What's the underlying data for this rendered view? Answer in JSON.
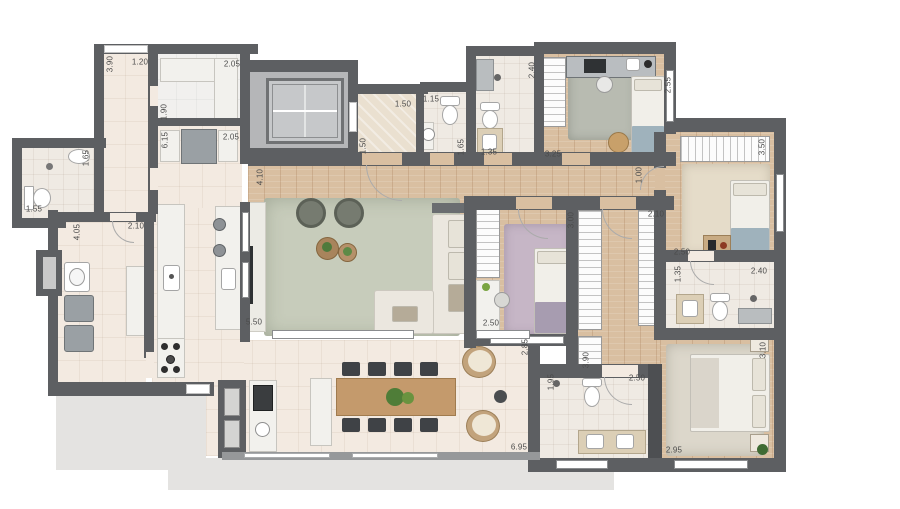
{
  "plan": {
    "type": "apartment-floor-plan-top-view",
    "unit_hint": "meters",
    "colors": {
      "wall": "#5d5f62",
      "wood_floor": "#d9bfa1",
      "tile_floor": "#f3eae1",
      "common_area_floor": "#b5b6b8",
      "living_rug": "#c7ccbb",
      "bedroom3_rug": "#c6b6c6",
      "master_rug": "#dcd7cb",
      "blanket_blue": "#9fb2bc",
      "dining_table_wood": "#c49a6c",
      "shadow": "#e4e3e1"
    },
    "dimensions": [
      {
        "text": "3.90",
        "x": 110,
        "y": 64,
        "vertical": true
      },
      {
        "text": "1.20",
        "x": 140,
        "y": 62,
        "vertical": false
      },
      {
        "text": "2.05",
        "x": 232,
        "y": 64,
        "vertical": false
      },
      {
        "text": "1.90",
        "x": 164,
        "y": 112,
        "vertical": true
      },
      {
        "text": "6.15",
        "x": 165,
        "y": 140,
        "vertical": true
      },
      {
        "text": "2.05",
        "x": 231,
        "y": 137,
        "vertical": false
      },
      {
        "text": "1.65",
        "x": 86,
        "y": 158,
        "vertical": true
      },
      {
        "text": "1.55",
        "x": 34,
        "y": 209,
        "vertical": false
      },
      {
        "text": "4.05",
        "x": 77,
        "y": 232,
        "vertical": true
      },
      {
        "text": "2.10",
        "x": 136,
        "y": 226,
        "vertical": false
      },
      {
        "text": "4.10",
        "x": 260,
        "y": 177,
        "vertical": true
      },
      {
        "text": "5.50",
        "x": 254,
        "y": 322,
        "vertical": false
      },
      {
        "text": "1.50",
        "x": 403,
        "y": 104,
        "vertical": false
      },
      {
        "text": "1.50",
        "x": 363,
        "y": 146,
        "vertical": true
      },
      {
        "text": "1.15",
        "x": 431,
        "y": 99,
        "vertical": false
      },
      {
        "text": "1.65",
        "x": 461,
        "y": 147,
        "vertical": true
      },
      {
        "text": "1.35",
        "x": 489,
        "y": 152,
        "vertical": false
      },
      {
        "text": "2.40",
        "x": 532,
        "y": 70,
        "vertical": true
      },
      {
        "text": "3.25",
        "x": 553,
        "y": 154,
        "vertical": false
      },
      {
        "text": "2.55",
        "x": 668,
        "y": 85,
        "vertical": true
      },
      {
        "text": "3.50",
        "x": 762,
        "y": 147,
        "vertical": true
      },
      {
        "text": "1.00",
        "x": 639,
        "y": 175,
        "vertical": true
      },
      {
        "text": "2.10",
        "x": 656,
        "y": 214,
        "vertical": false
      },
      {
        "text": "3.00",
        "x": 571,
        "y": 220,
        "vertical": true
      },
      {
        "text": "2.50",
        "x": 682,
        "y": 252,
        "vertical": false
      },
      {
        "text": "1.35",
        "x": 678,
        "y": 274,
        "vertical": true
      },
      {
        "text": "2.40",
        "x": 759,
        "y": 271,
        "vertical": false
      },
      {
        "text": "2.50",
        "x": 491,
        "y": 323,
        "vertical": false
      },
      {
        "text": "2.85",
        "x": 525,
        "y": 347,
        "vertical": true
      },
      {
        "text": "3.90",
        "x": 586,
        "y": 360,
        "vertical": true
      },
      {
        "text": "1.95",
        "x": 551,
        "y": 382,
        "vertical": true
      },
      {
        "text": "2.50",
        "x": 637,
        "y": 378,
        "vertical": false
      },
      {
        "text": "3.10",
        "x": 763,
        "y": 350,
        "vertical": true
      },
      {
        "text": "2.95",
        "x": 674,
        "y": 450,
        "vertical": false
      },
      {
        "text": "6.95",
        "x": 519,
        "y": 447,
        "vertical": false
      }
    ]
  }
}
